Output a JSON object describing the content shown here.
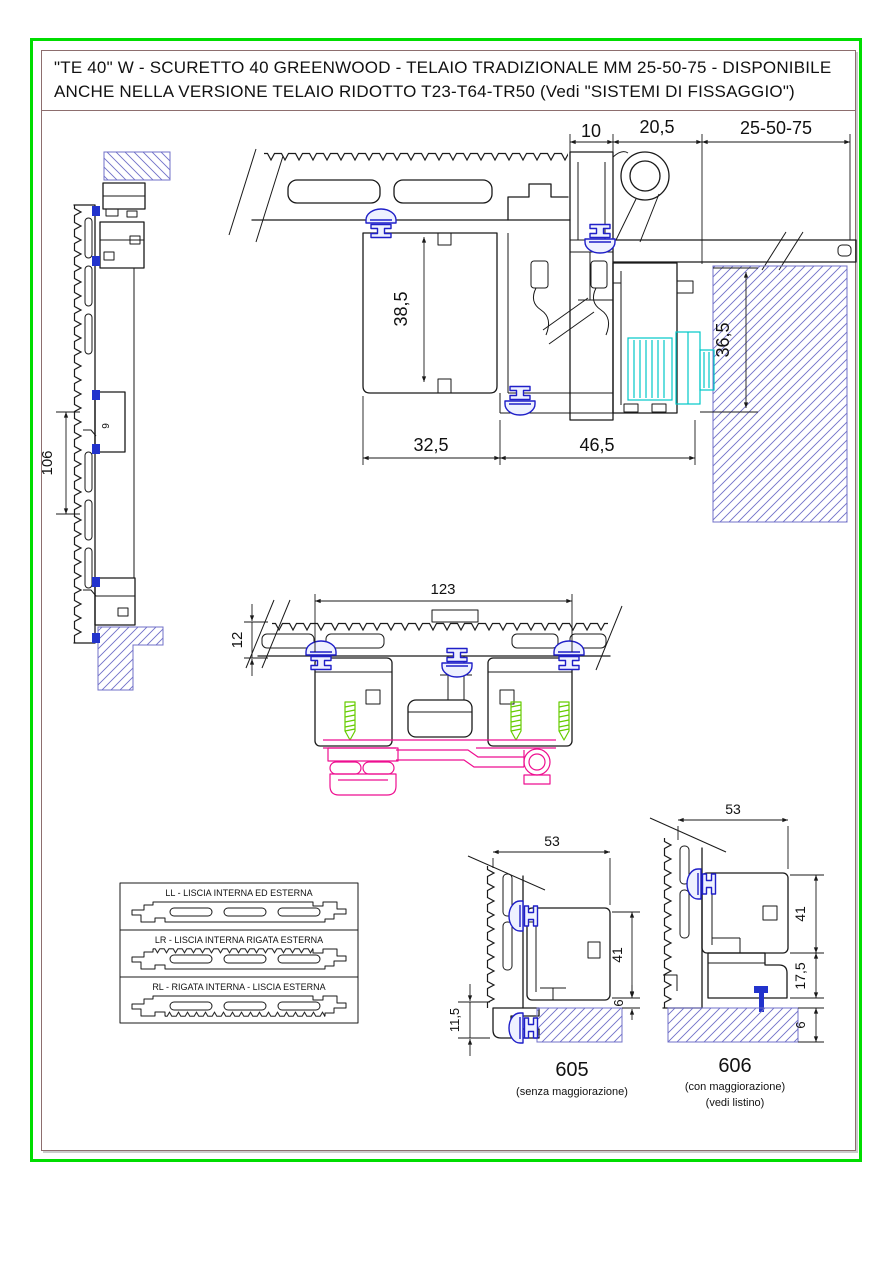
{
  "page": {
    "background": "#ffffff",
    "outer_border_color": "#00dd00",
    "inner_border_color": "#8d6e6e"
  },
  "colors": {
    "line": "#1a1a1a",
    "masonry_hatch_blue": "#7070c8",
    "gasket_clip_blue": "#1f1fc8",
    "anchor_screw_cyan": "#00c8c8",
    "fixing_screw_green": "#66cc00",
    "hinge_magenta": "#ee0f90"
  },
  "title": {
    "line1": "\"TE 40\" W - SCURETTO 40 GREENWOOD - TELAIO TRADIZIONALE MM 25-50-75 - DISPONIBILE",
    "line2": "ANCHE NELLA VERSIONE TELAIO RIDOTTO T23-T64-TR50 (Vedi \"SISTEMI DI FISSAGGIO\")"
  },
  "main_section": {
    "dim_top_1": "10",
    "dim_top_2": "20,5",
    "dim_top_3": "25-50-75",
    "dim_height_inner": "38,5",
    "dim_wall": "36,5",
    "dim_bottom_left": "32,5",
    "dim_bottom_right": "46,5"
  },
  "left_section": {
    "dim_length": "106",
    "marking": "9"
  },
  "middle_section": {
    "dim_width": "123",
    "dim_thickness": "12"
  },
  "legend": {
    "items": [
      {
        "label": "LL - LISCIA INTERNA ED ESTERNA"
      },
      {
        "label": "LR - LISCIA INTERNA RIGATA ESTERNA"
      },
      {
        "label": "RL - RIGATA INTERNA - LISCIA ESTERNA"
      }
    ]
  },
  "detail_605": {
    "dim_width": "53",
    "dim_height": "41",
    "dim_gap": "6",
    "dim_offset": "11,5",
    "number": "605",
    "caption": "(senza maggiorazione)"
  },
  "detail_606": {
    "dim_width": "53",
    "dim_height": "41",
    "dim_spacer": "17,5",
    "dim_gap": "6",
    "number": "606",
    "caption1": "(con maggiorazione)",
    "caption2": "(vedi listino)"
  }
}
